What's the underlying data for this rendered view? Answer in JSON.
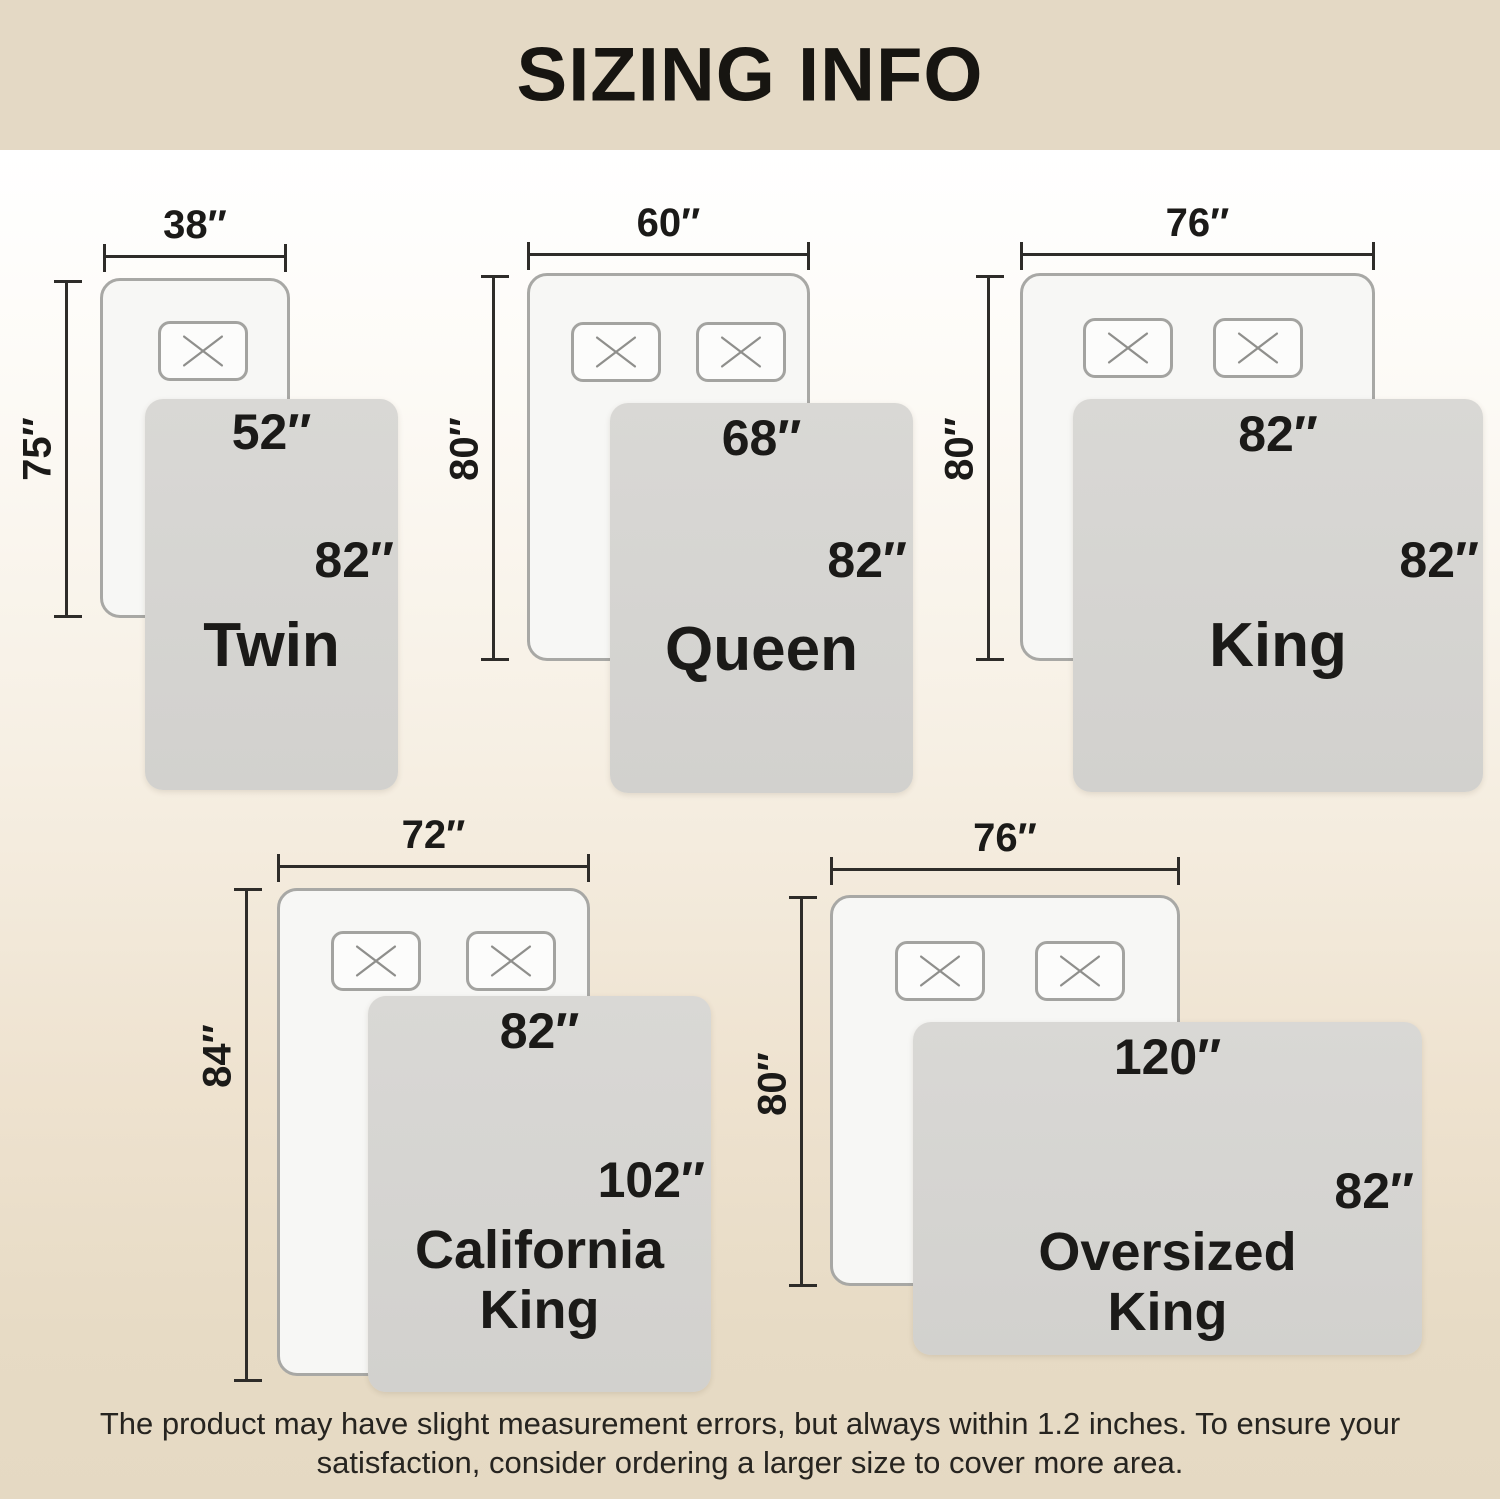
{
  "title": "SIZING INFO",
  "sizes": [
    {
      "name": "Twin",
      "bed_width": "38″",
      "bed_length": "75″",
      "blanket_width": "52″",
      "blanket_length": "82″",
      "pillow_count": 1
    },
    {
      "name": "Queen",
      "bed_width": "60″",
      "bed_length": "80″",
      "blanket_width": "68″",
      "blanket_length": "82″",
      "pillow_count": 2
    },
    {
      "name": "King",
      "bed_width": "76″",
      "bed_length": "80″",
      "blanket_width": "82″",
      "blanket_length": "82″",
      "pillow_count": 2
    },
    {
      "name": "California King",
      "bed_width": "72″",
      "bed_length": "84″",
      "blanket_width": "82″",
      "blanket_length": "102″",
      "pillow_count": 2
    },
    {
      "name": "Oversized King",
      "bed_width": "76″",
      "bed_length": "80″",
      "blanket_width": "120″",
      "blanket_length": "82″",
      "pillow_count": 2
    }
  ],
  "disclaimer": {
    "line1": "The product may have slight measurement errors, but always within 1.2 inches. To ensure your",
    "line2": "satisfaction, consider ordering a larger size to cover more area."
  },
  "icons": {
    "pillow_marker": "x-cross"
  },
  "colors": {
    "banner": "#e4d9c5",
    "background_top": "#ffffff",
    "background_bottom": "#e5d9c3",
    "mattress": "#f7f7f5",
    "mattress_border": "#a8a8a5",
    "blanket": "#d4d3d0",
    "dimension_line": "#2e2c29",
    "text": "#1b1a18"
  }
}
